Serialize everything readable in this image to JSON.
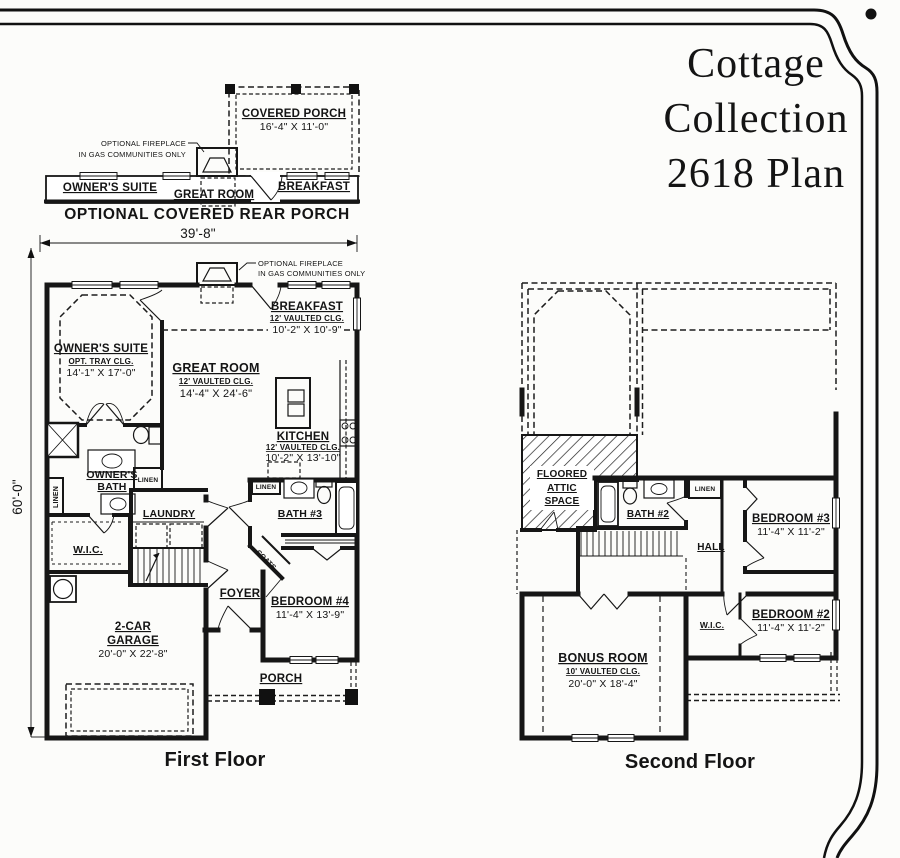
{
  "plan_title": {
    "line1": "Cottage",
    "line2": "Collection",
    "line3": "2618 Plan"
  },
  "rear_porch_option": {
    "covered_porch_name": "COVERED PORCH",
    "covered_porch_dims": "16'-4\" X 11'-0\"",
    "fireplace_note_1": "OPTIONAL FIREPLACE",
    "fireplace_note_2": "IN GAS COMMUNITIES ONLY",
    "owners_suite": "OWNER'S SUITE",
    "great_room": "GREAT ROOM",
    "breakfast": "BREAKFAST",
    "caption": "OPTIONAL COVERED REAR PORCH"
  },
  "first_floor": {
    "caption": "First Floor",
    "overall_width": "39'-8\"",
    "overall_depth": "60'-0\"",
    "fireplace_note_1": "OPTIONAL FIREPLACE",
    "fireplace_note_2": "IN GAS COMMUNITIES ONLY",
    "owners_suite_name": "OWNER'S SUITE",
    "owners_suite_ceiling": "OPT. TRAY CLG.",
    "owners_suite_dims": "14'-1\" X 17'-0\"",
    "great_room_name": "GREAT ROOM",
    "great_room_ceiling": "12' VAULTED CLG.",
    "great_room_dims": "14'-4\" X 24'-6\"",
    "breakfast_name": "BREAKFAST",
    "breakfast_ceiling": "12' VAULTED CLG.",
    "breakfast_dims": "10'-2\" X 10'-9\"",
    "kitchen_name": "KITCHEN",
    "kitchen_ceiling": "12' VAULTED CLG.",
    "kitchen_dims": "10'-2\" X 13'-10\"",
    "owners_bath_1": "OWNER'S",
    "owners_bath_2": "BATH",
    "wic": "W.I.C.",
    "laundry": "LAUNDRY",
    "linen_side": "LINEN",
    "linen_hall": "LINEN",
    "linen_bath3": "LINEN",
    "bath3": "BATH #3",
    "coats": "COATS",
    "foyer": "FOYER",
    "bedroom4_name": "BEDROOM #4",
    "bedroom4_dims": "11'-4\" X 13'-9\"",
    "garage_1": "2-CAR",
    "garage_2": "GARAGE",
    "garage_dims": "20'-0\" X 22'-8\"",
    "porch": "PORCH"
  },
  "second_floor": {
    "caption": "Second Floor",
    "attic_1": "FLOORED",
    "attic_2": "ATTIC",
    "attic_3": "SPACE",
    "bath2": "BATH #2",
    "linen": "LINEN",
    "hall": "HALL",
    "bedroom3_name": "BEDROOM #3",
    "bedroom3_dims": "11'-4\" X 11'-2\"",
    "wic": "W.I.C.",
    "bedroom2_name": "BEDROOM #2",
    "bedroom2_dims": "11'-4\" X 11'-2\"",
    "bonus_name": "BONUS ROOM",
    "bonus_ceiling": "10' VAULTED CLG.",
    "bonus_dims": "20'-0\" X 18'-4\""
  }
}
